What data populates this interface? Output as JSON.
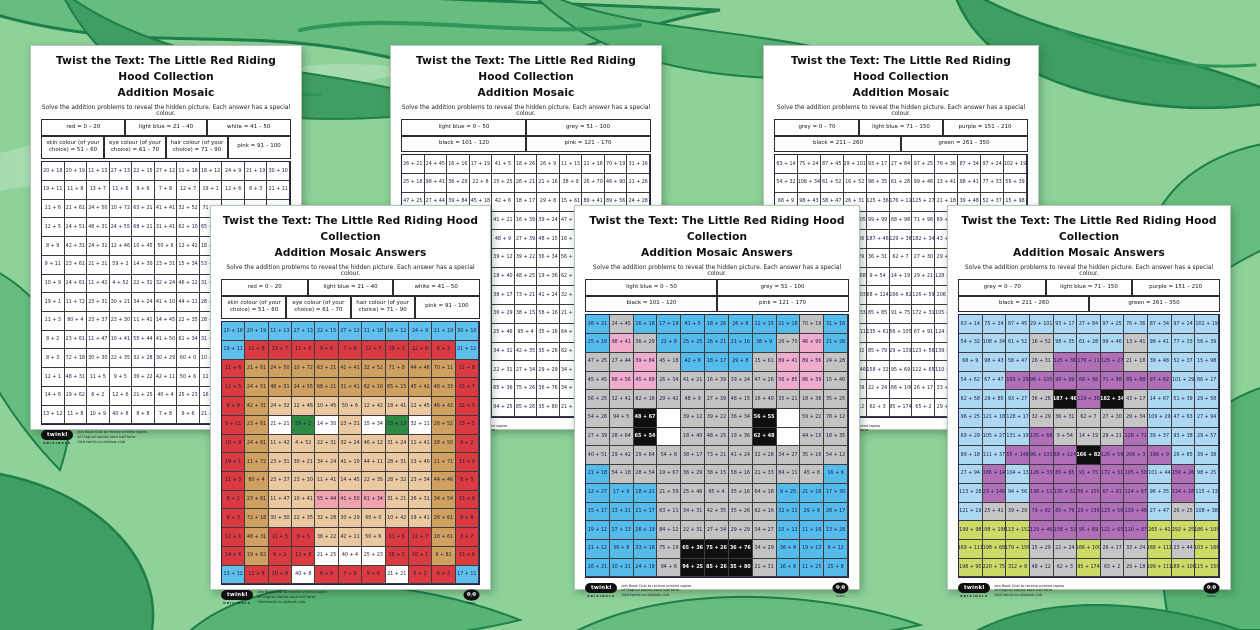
{
  "shared": {
    "title_line1": "Twist the Text: The Little Red Riding Hood Collection",
    "title_line2": "Addition Mosaic",
    "answers_suffix": " Answers",
    "subtitle": "Solve the addition problems to reveal the hidden picture. Each answer has a special colour.",
    "footer": {
      "logo_text": "twinkl",
      "logo_sub": "ORIGINALS",
      "line1": "Join Book Club to receive printed copies",
      "line2": "of Original stories each half term.",
      "line3": "Visit twinkl.co.uk/book-club",
      "owl_logo": "twinkl-owl-badge"
    }
  },
  "cell_format": "addition expression | colour code (lb=light blue, rd=red, wh=white, sk=skin, ey=eye, hr=hair, pk=pink, gy=grey, bk=black, pu=purple, gn=green)",
  "designs": {
    "riding_hood": {
      "key_rows": [
        [
          "red = 0 – 20",
          "light blue = 21 – 40",
          "white = 41 – 50"
        ],
        [
          "skin colour (of your choice) = 51 – 60",
          "eye colour (of your choice) = 61 – 70",
          "hair colour (of your choice) = 71 – 90",
          "pink = 91 – 100"
        ]
      ],
      "palette": {
        "light_blue": "#5fc0ee",
        "red": "#da3b40",
        "white": "#ffffff",
        "skin": "#eac9a0",
        "eye_green": "#2c8a43",
        "hair_tan": "#cfa05f",
        "pink": "#f0a3ae"
      },
      "grid": [
        [
          "20 + 18|lb",
          "20 + 19|lb",
          "11 + 13|lb",
          "27 + 13|lb",
          "22 + 15|lb",
          "27 + 12|lb",
          "11 + 18|lb",
          "18 + 12|lb",
          "24 + 9|lb",
          "21 + 19|lb",
          "30 + 10|lb"
        ],
        [
          "19 + 11|lb",
          "11 + 8|rd",
          "13 + 7|rd",
          "11 + 6|rd",
          "9 + 6|rd",
          "7 + 8|rd",
          "12 + 7|rd",
          "19 + 1|rd",
          "12 + 6|rd",
          "6 + 3|rd",
          "21 + 11|lb"
        ],
        [
          "11 + 6|rd",
          "21 + 61|hr",
          "24 + 50|hr",
          "10 + 72|hr",
          "63 + 21|hr",
          "41 + 41|hr",
          "32 + 52|hr",
          "71 + 8|hr",
          "44 + 46|hr",
          "70 + 11|hr",
          "11 + 8|rd"
        ],
        [
          "12 + 5|rd",
          "24 + 51|hr",
          "48 + 31|hr",
          "24 + 55|hr",
          "68 + 21|hr",
          "31 + 41|hr",
          "62 + 10|hr",
          "65 + 15|hr",
          "45 + 42|hr",
          "48 + 33|hr",
          "13 + 7|rd"
        ],
        [
          "8 + 9|rd",
          "42 + 31|hr",
          "24 + 32|sk",
          "12 + 46|sk",
          "10 + 45|sk",
          "50 + 6|sk",
          "12 + 42|sk",
          "18 + 41|sk",
          "12 + 45|sk",
          "46 + 42|hr",
          "12 + 5|rd"
        ],
        [
          "9 + 11|rd",
          "23 + 61|hr",
          "21 + 21|wh",
          "59 + 2|ey",
          "14 + 30|wh",
          "23 + 31|sk",
          "15 + 34|wh",
          "53 + 13|ey",
          "32 + 11|wh",
          "28 + 52|hr",
          "13 + 5|rd"
        ],
        [
          "10 + 9|rd",
          "24 + 61|hr",
          "11 + 42|sk",
          "4 + 52|sk",
          "22 + 31|sk",
          "32 + 24|sk",
          "46 + 12|sk",
          "31 + 24|sk",
          "11 + 41|sk",
          "28 + 50|hr",
          "9 + 2|rd"
        ],
        [
          "19 + 1|rd",
          "11 + 72|hr",
          "23 + 31|sk",
          "30 + 21|sk",
          "34 + 24|sk",
          "41 + 10|sk",
          "44 + 11|sk",
          "28 + 31|sk",
          "13 + 40|sk",
          "11 + 71|hr",
          "11 + 9|rd"
        ],
        [
          "11 + 3|rd",
          "80 + 4|hr",
          "23 + 37|sk",
          "23 + 30|sk",
          "11 + 41|sk",
          "14 + 45|sk",
          "22 + 35|sk",
          "28 + 32|sk",
          "23 + 34|sk",
          "44 + 46|hr",
          "8 + 3|rd"
        ],
        [
          "8 + 2|rd",
          "23 + 61|hr",
          "11 + 47|sk",
          "10 + 41|sk",
          "55 + 44|pk",
          "41 + 50|pk",
          "61 + 34|pk",
          "31 + 21|sk",
          "26 + 31|sk",
          "34 + 54|hr",
          "11 + 8|rd"
        ],
        [
          "8 + 3|rd",
          "72 + 18|hr",
          "30 + 30|sk",
          "22 + 35|sk",
          "32 + 28|sk",
          "30 + 29|sk",
          "60 + 0|sk",
          "10 + 42|sk",
          "19 + 41|sk",
          "26 + 61|hr",
          "8 + 8|rd"
        ],
        [
          "12 + 1|rd",
          "48 + 31|hr",
          "11 + 5|rd",
          "9 + 5|rd",
          "36 + 22|sk",
          "42 + 11|sk",
          "50 + 6|sk",
          "11 + 8|rd",
          "12 + 7|rd",
          "18 + 61|hr",
          "8 + 7|rd"
        ],
        [
          "14 + 6|rd",
          "19 + 62|hr",
          "6 + 2|rd",
          "12 + 6|rd",
          "21 + 25|wh",
          "40 + 4|wh",
          "25 + 23|wh",
          "16 + 2|rd",
          "10 + 1|rd",
          "9 + 81|hr",
          "11 + 6|rd"
        ],
        [
          "13 + 12|lb",
          "11 + 8|rd",
          "10 + 9|rd",
          "40 + 8|wh",
          "8 + 8|rd",
          "7 + 8|rd",
          "9 + 6|rd",
          "21 + 21|wh",
          "5 + 2|rd",
          "6 + 2|rd",
          "17 + 11|lb"
        ]
      ]
    },
    "wolf": {
      "key_rows": [
        [
          "light blue = 0 – 50",
          "grey = 51 – 100"
        ],
        [
          "black = 101 – 120",
          "pink = 121 – 170"
        ]
      ],
      "palette": {
        "light_blue": "#55bbea",
        "grey": "#c3c3c3",
        "black": "#0f0f0f",
        "pink": "#efaccd",
        "white": "#ffffff"
      },
      "grid": [
        [
          "26 + 21|lb",
          "24 + 45|gy",
          "16 + 16|lb",
          "17 + 19|lb",
          "41 + 5|lb",
          "18 + 26|lb",
          "26 + 9|lb",
          "11 + 15|lb",
          "21 + 16|lb",
          "70 + 19|gy",
          "31 + 16|lb"
        ],
        [
          "25 + 18|lb",
          "98 + 41|pk",
          "36 + 29|gy",
          "22 + 8|lb",
          "25 + 25|lb",
          "26 + 21|lb",
          "21 + 16|lb",
          "38 + 9|lb",
          "26 + 70|gy",
          "46 + 90|pk",
          "21 + 26|lb"
        ],
        [
          "47 + 25|gy",
          "27 + 44|gy",
          "39 + 84|pk",
          "45 + 18|gy",
          "42 + 6|lb",
          "18 + 17|lb",
          "29 + 8|lb",
          "15 + 61|gy",
          "89 + 41|pk",
          "89 + 56|pk",
          "24 + 28|gy"
        ],
        [
          "45 + 45|gy",
          "88 + 56|pk",
          "45 + 89|pk",
          "26 + 34|gy",
          "41 + 21|gy",
          "16 + 39|gy",
          "39 + 24|gy",
          "47 + 26|gy",
          "56 + 85|pk",
          "86 + 39|pk",
          "15 + 40|gy"
        ],
        [
          "56 + 25|gy",
          "32 + 41|gy",
          "82 + 16|gy",
          "29 + 42|gy",
          "48 + 9|gy",
          "27 + 39|gy",
          "48 + 15|gy",
          "16 + 40|gy",
          "35 + 21|gy",
          "18 + 36|gy",
          "35 + 25|gy"
        ],
        [
          "54 + 26|gy",
          "94 + 5|gy",
          "48 + 67|bk",
          "|wh",
          "39 + 12|gy",
          "39 + 22|gy",
          "36 + 34|gy",
          "56 + 55|bk",
          "|wh",
          "59 + 22|gy",
          "78 + 12|gy"
        ],
        [
          "27 + 39|gy",
          "28 + 64|gy",
          "65 + 54|bk",
          "|wh",
          "18 + 40|gy",
          "48 + 25|gy",
          "19 + 36|gy",
          "62 + 48|bk",
          "|wh",
          "44 + 15|gy",
          "18 + 35|gy"
        ],
        [
          "40 + 51|gy",
          "29 + 42|gy",
          "29 + 64|gy",
          "54 + 8|gy",
          "38 + 17|gy",
          "73 + 21|gy",
          "41 + 24|gy",
          "32 + 28|gy",
          "34 + 27|gy",
          "35 + 16|gy",
          "54 + 12|gy"
        ],
        [
          "21 + 18|lb",
          "54 + 18|gy",
          "28 + 54|gy",
          "19 + 67|gy",
          "36 + 29|gy",
          "38 + 15|gy",
          "58 + 16|gy",
          "21 + 33|gy",
          "84 + 11|gy",
          "45 + 8|gy",
          "16 + 9|lb"
        ],
        [
          "12 + 27|lb",
          "17 + 9|lb",
          "18 + 21|lb",
          "21 + 59|gy",
          "25 + 46|gy",
          "95 + 4|gy",
          "35 + 16|gy",
          "64 + 18|gy",
          "9 + 25|lb",
          "21 + 16|lb",
          "17 + 30|lb"
        ],
        [
          "15 + 17|lb",
          "13 + 21|lb",
          "21 + 17|lb",
          "63 + 11|gy",
          "34 + 31|gy",
          "42 + 35|gy",
          "35 + 26|gy",
          "62 + 16|gy",
          "32 + 11|lb",
          "29 + 8|lb",
          "28 + 17|lb"
        ],
        [
          "19 + 12|lb",
          "27 + 13|lb",
          "26 + 19|lb",
          "84 + 12|gy",
          "22 + 31|gy",
          "27 + 34|gy",
          "29 + 29|gy",
          "34 + 27|gy",
          "15 + 12|lb",
          "11 + 16|lb",
          "13 + 28|lb"
        ],
        [
          "21 + 12|lb",
          "39 + 8|lb",
          "33 + 16|lb",
          "75 + 19|gy",
          "65 + 36|bk",
          "75 + 26|bk",
          "36 + 76|bk",
          "34 + 29|gy",
          "36 + 4|lb",
          "19 + 13|lb",
          "9 + 12|lb"
        ],
        [
          "26 + 21|lb",
          "10 + 21|lb",
          "24 + 19|lb",
          "94 + 6|gy",
          "94 + 25|bk",
          "85 + 26|bk",
          "35 + 80|bk",
          "21 + 31|gy",
          "16 + 8|lb",
          "11 + 25|lb",
          "25 + 8|lb"
        ]
      ]
    },
    "grandma": {
      "key_rows": [
        [
          "grey = 0 – 70",
          "light blue = 71 – 150",
          "purple = 151 – 210"
        ],
        [
          "black = 211 – 260",
          "green = 261 – 350"
        ]
      ],
      "palette": {
        "grey": "#c6c6c6",
        "light_blue": "#add8f2",
        "purple": "#b16fb8",
        "black": "#0f0f0f",
        "green": "#ccda66"
      },
      "grid": [
        [
          "63 + 14|lb",
          "75 + 24|lb",
          "87 + 45|lb",
          "29 + 101|lb",
          "93 + 17|lb",
          "27 + 84|lb",
          "97 + 25|lb",
          "76 + 36|lb",
          "87 + 34|lb",
          "97 + 24|lb",
          "102 + 19|lb"
        ],
        [
          "54 + 32|lb",
          "108 + 34|lb",
          "61 + 52|lb",
          "16 + 52|gy",
          "98 + 35|lb",
          "61 + 28|lb",
          "99 + 46|lb",
          "13 + 41|gy",
          "98 + 41|lb",
          "77 + 33|lb",
          "56 + 39|lb"
        ],
        [
          "68 + 9|lb",
          "98 + 43|lb",
          "58 + 47|lb",
          "26 + 31|gy",
          "125 + 36|pu",
          "176 + 11|pu",
          "125 + 27|pu",
          "21 + 18|gy",
          "39 + 48|lb",
          "52 + 37|lb",
          "15 + 98|lb"
        ],
        [
          "54 + 62|lb",
          "67 + 47|lb",
          "169 + 29|pu",
          "96 + 105|pu",
          "99 + 99|pu",
          "68 + 98|pu",
          "71 + 98|pu",
          "89 + 88|pu",
          "97 + 82|pu",
          "101 + 29|lb",
          "86 + 27|lb"
        ],
        [
          "62 + 58|lb",
          "29 + 85|lb",
          "93 + 27|lb",
          "36 + 26|gy",
          "187 + 46|bk",
          "129 + 36|pu",
          "182 + 34|bk",
          "43 + 17|gy",
          "14 + 67|lb",
          "51 + 39|lb",
          "29 + 58|lb"
        ],
        [
          "96 + 25|lb",
          "121 + 18|lb",
          "128 + 17|lb",
          "32 + 29|gy",
          "36 + 31|gy",
          "62 + 7|gy",
          "27 + 30|gy",
          "29 + 34|gy",
          "109 + 29|lb",
          "47 + 63|lb",
          "27 + 94|lb"
        ],
        [
          "69 + 29|lb",
          "105 + 27|lb",
          "131 + 19|lb",
          "105 + 68|pu",
          "9 + 54|gy",
          "14 + 19|gy",
          "29 + 21|gy",
          "128 + 71|pu",
          "39 + 37|lb",
          "93 + 38|lb",
          "29 + 57|lb"
        ],
        [
          "89 + 18|lb",
          "111 + 37|lb",
          "55 + 148|pu",
          "96 + 103|pu",
          "68 + 124|pu",
          "166 + 82|bk",
          "126 + 59|pu",
          "206 + 3|pu",
          "198 + 9|pu",
          "26 + 85|lb",
          "39 + 38|lb"
        ],
        [
          "27 + 94|lb",
          "186 + 14|pu",
          "104 + 13|lb",
          "126 + 33|pu",
          "85 + 85|pu",
          "91 + 75|pu",
          "172 + 31|pu",
          "105 + 58|pu",
          "101 + 44|lb",
          "156 + 26|pu",
          "98 + 25|lb"
        ],
        [
          "113 + 28|lb",
          "23 + 146|pu",
          "94 + 56|lb",
          "198 + 11|pu",
          "135 + 61|pu",
          "56 + 105|pu",
          "67 + 91|pu",
          "124 + 67|pu",
          "96 + 35|lb",
          "134 + 18|pu",
          "115 + 13|lb"
        ],
        [
          "121 + 19|lb",
          "25 + 41|gy",
          "39 + 29|gy",
          "79 + 82|pu",
          "85 + 79|pu",
          "29 + 139|pu",
          "123 + 56|pu",
          "139 + 48|pu",
          "27 + 47|lb",
          "26 + 25|gy",
          "108 + 38|lb"
        ],
        [
          "199 + 98|gn",
          "108 + 196|gn",
          "113 + 152|gn",
          "129 + 46|pu",
          "158 + 32|pu",
          "95 + 69|pu",
          "122 + 65|pu",
          "110 + 87|pu",
          "265 + 41|gn",
          "292 + 25|gn",
          "186 + 109|gn"
        ],
        [
          "169 + 111|gn",
          "198 + 68|gn",
          "179 + 156|gn",
          "15 + 29|gy",
          "22 + 24|gy",
          "166 + 100|gn",
          "26 + 17|gy",
          "33 + 24|gy",
          "168 + 111|gn",
          "23 + 44|gy",
          "103 + 166|gn"
        ],
        [
          "198 + 95|gn",
          "220 + 75|gn",
          "312 + 8|gn",
          "48 + 12|gy",
          "62 + 3|gy",
          "95 + 174|gn",
          "65 + 2|gy",
          "29 + 18|gy",
          "199 + 111|gn",
          "189 + 100|gn",
          "115 + 150|gn"
        ]
      ]
    }
  },
  "pages": [
    {
      "id": "worksheet-riding-hood",
      "design": "riding_hood",
      "variant": "worksheet",
      "slot": "back-left"
    },
    {
      "id": "worksheet-wolf",
      "design": "wolf",
      "variant": "worksheet",
      "slot": "back-mid"
    },
    {
      "id": "worksheet-grandma",
      "design": "grandma",
      "variant": "worksheet",
      "slot": "back-right"
    },
    {
      "id": "answers-riding-hood",
      "design": "riding_hood",
      "variant": "answers",
      "slot": "front-left"
    },
    {
      "id": "answers-wolf",
      "design": "wolf",
      "variant": "answers",
      "slot": "front-mid"
    },
    {
      "id": "answers-grandma",
      "design": "grandma",
      "variant": "answers",
      "slot": "front-right"
    }
  ],
  "background": {
    "description": "green forest-leaves illustration",
    "base_color": "#8ed29a",
    "leaf_colors": [
      "#a7dcb0",
      "#67bd80",
      "#3f9e62",
      "#1e7f49"
    ]
  }
}
